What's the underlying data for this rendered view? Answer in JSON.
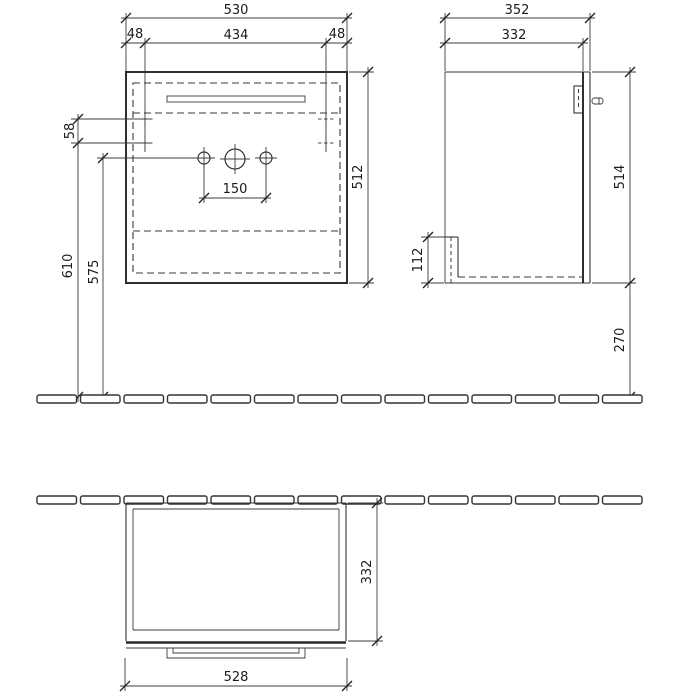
{
  "drawing": {
    "type": "furniture-dimension-drawing",
    "views": [
      "front-elevation",
      "side-elevation",
      "plan-view"
    ]
  },
  "dims": {
    "front": {
      "overall_width": "530",
      "side_offset_left": "48",
      "mount_spacing": "434",
      "side_offset_right": "48",
      "mount_drop": "58",
      "carcass_height": "512",
      "tap_hole_spacing": "150",
      "height_upper": "610",
      "height_lower": "575"
    },
    "side": {
      "overall_depth": "352",
      "carcass_depth": "332",
      "carcass_height": "514",
      "service_recess": "112",
      "floor_clearance": "270"
    },
    "plan": {
      "depth": "332",
      "front_width": "528"
    }
  }
}
